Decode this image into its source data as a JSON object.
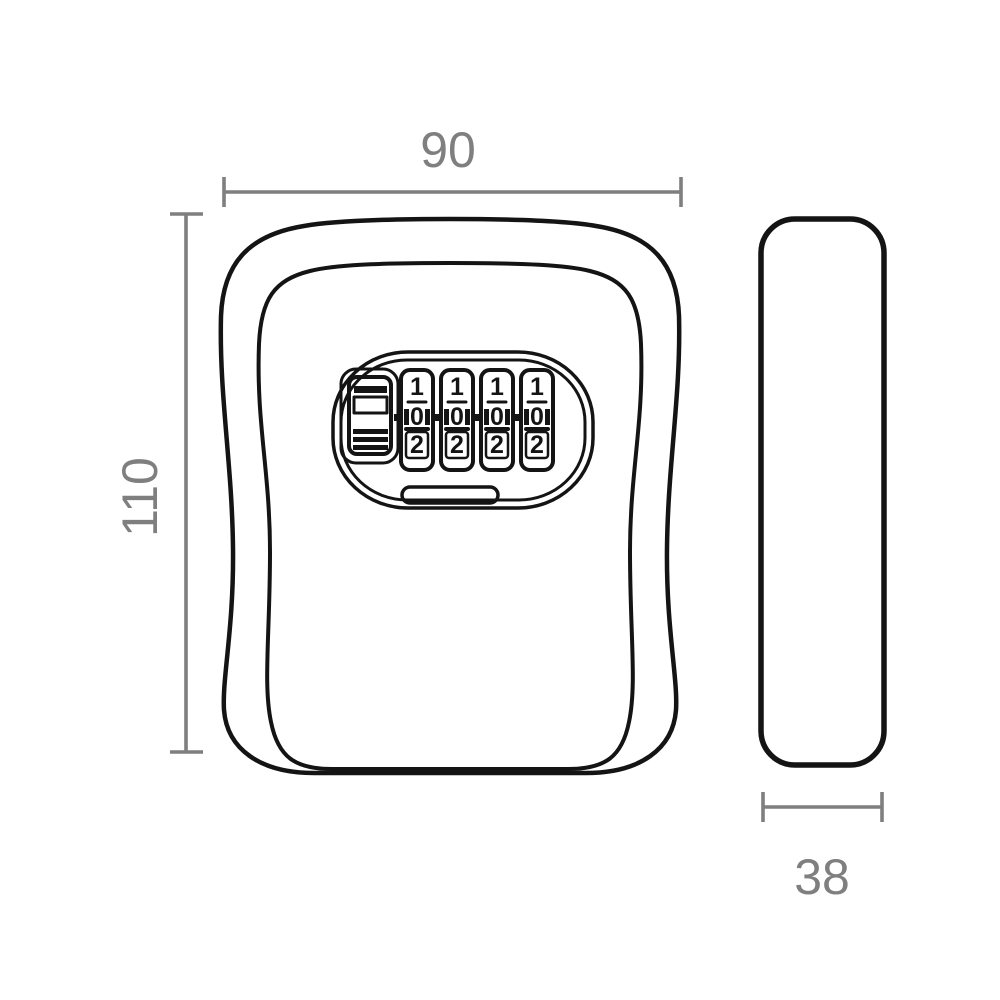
{
  "colors": {
    "background": "#ffffff",
    "line": "#141414",
    "dimension": "#7f7f7f"
  },
  "dimensions": {
    "width_label": "90",
    "height_label": "110",
    "depth_label": "38"
  },
  "lock": {
    "dials": [
      {
        "top": "1",
        "middle": "0",
        "bottom": "2"
      },
      {
        "top": "1",
        "middle": "0",
        "bottom": "2"
      },
      {
        "top": "1",
        "middle": "0",
        "bottom": "2"
      },
      {
        "top": "1",
        "middle": "0",
        "bottom": "2"
      }
    ]
  }
}
